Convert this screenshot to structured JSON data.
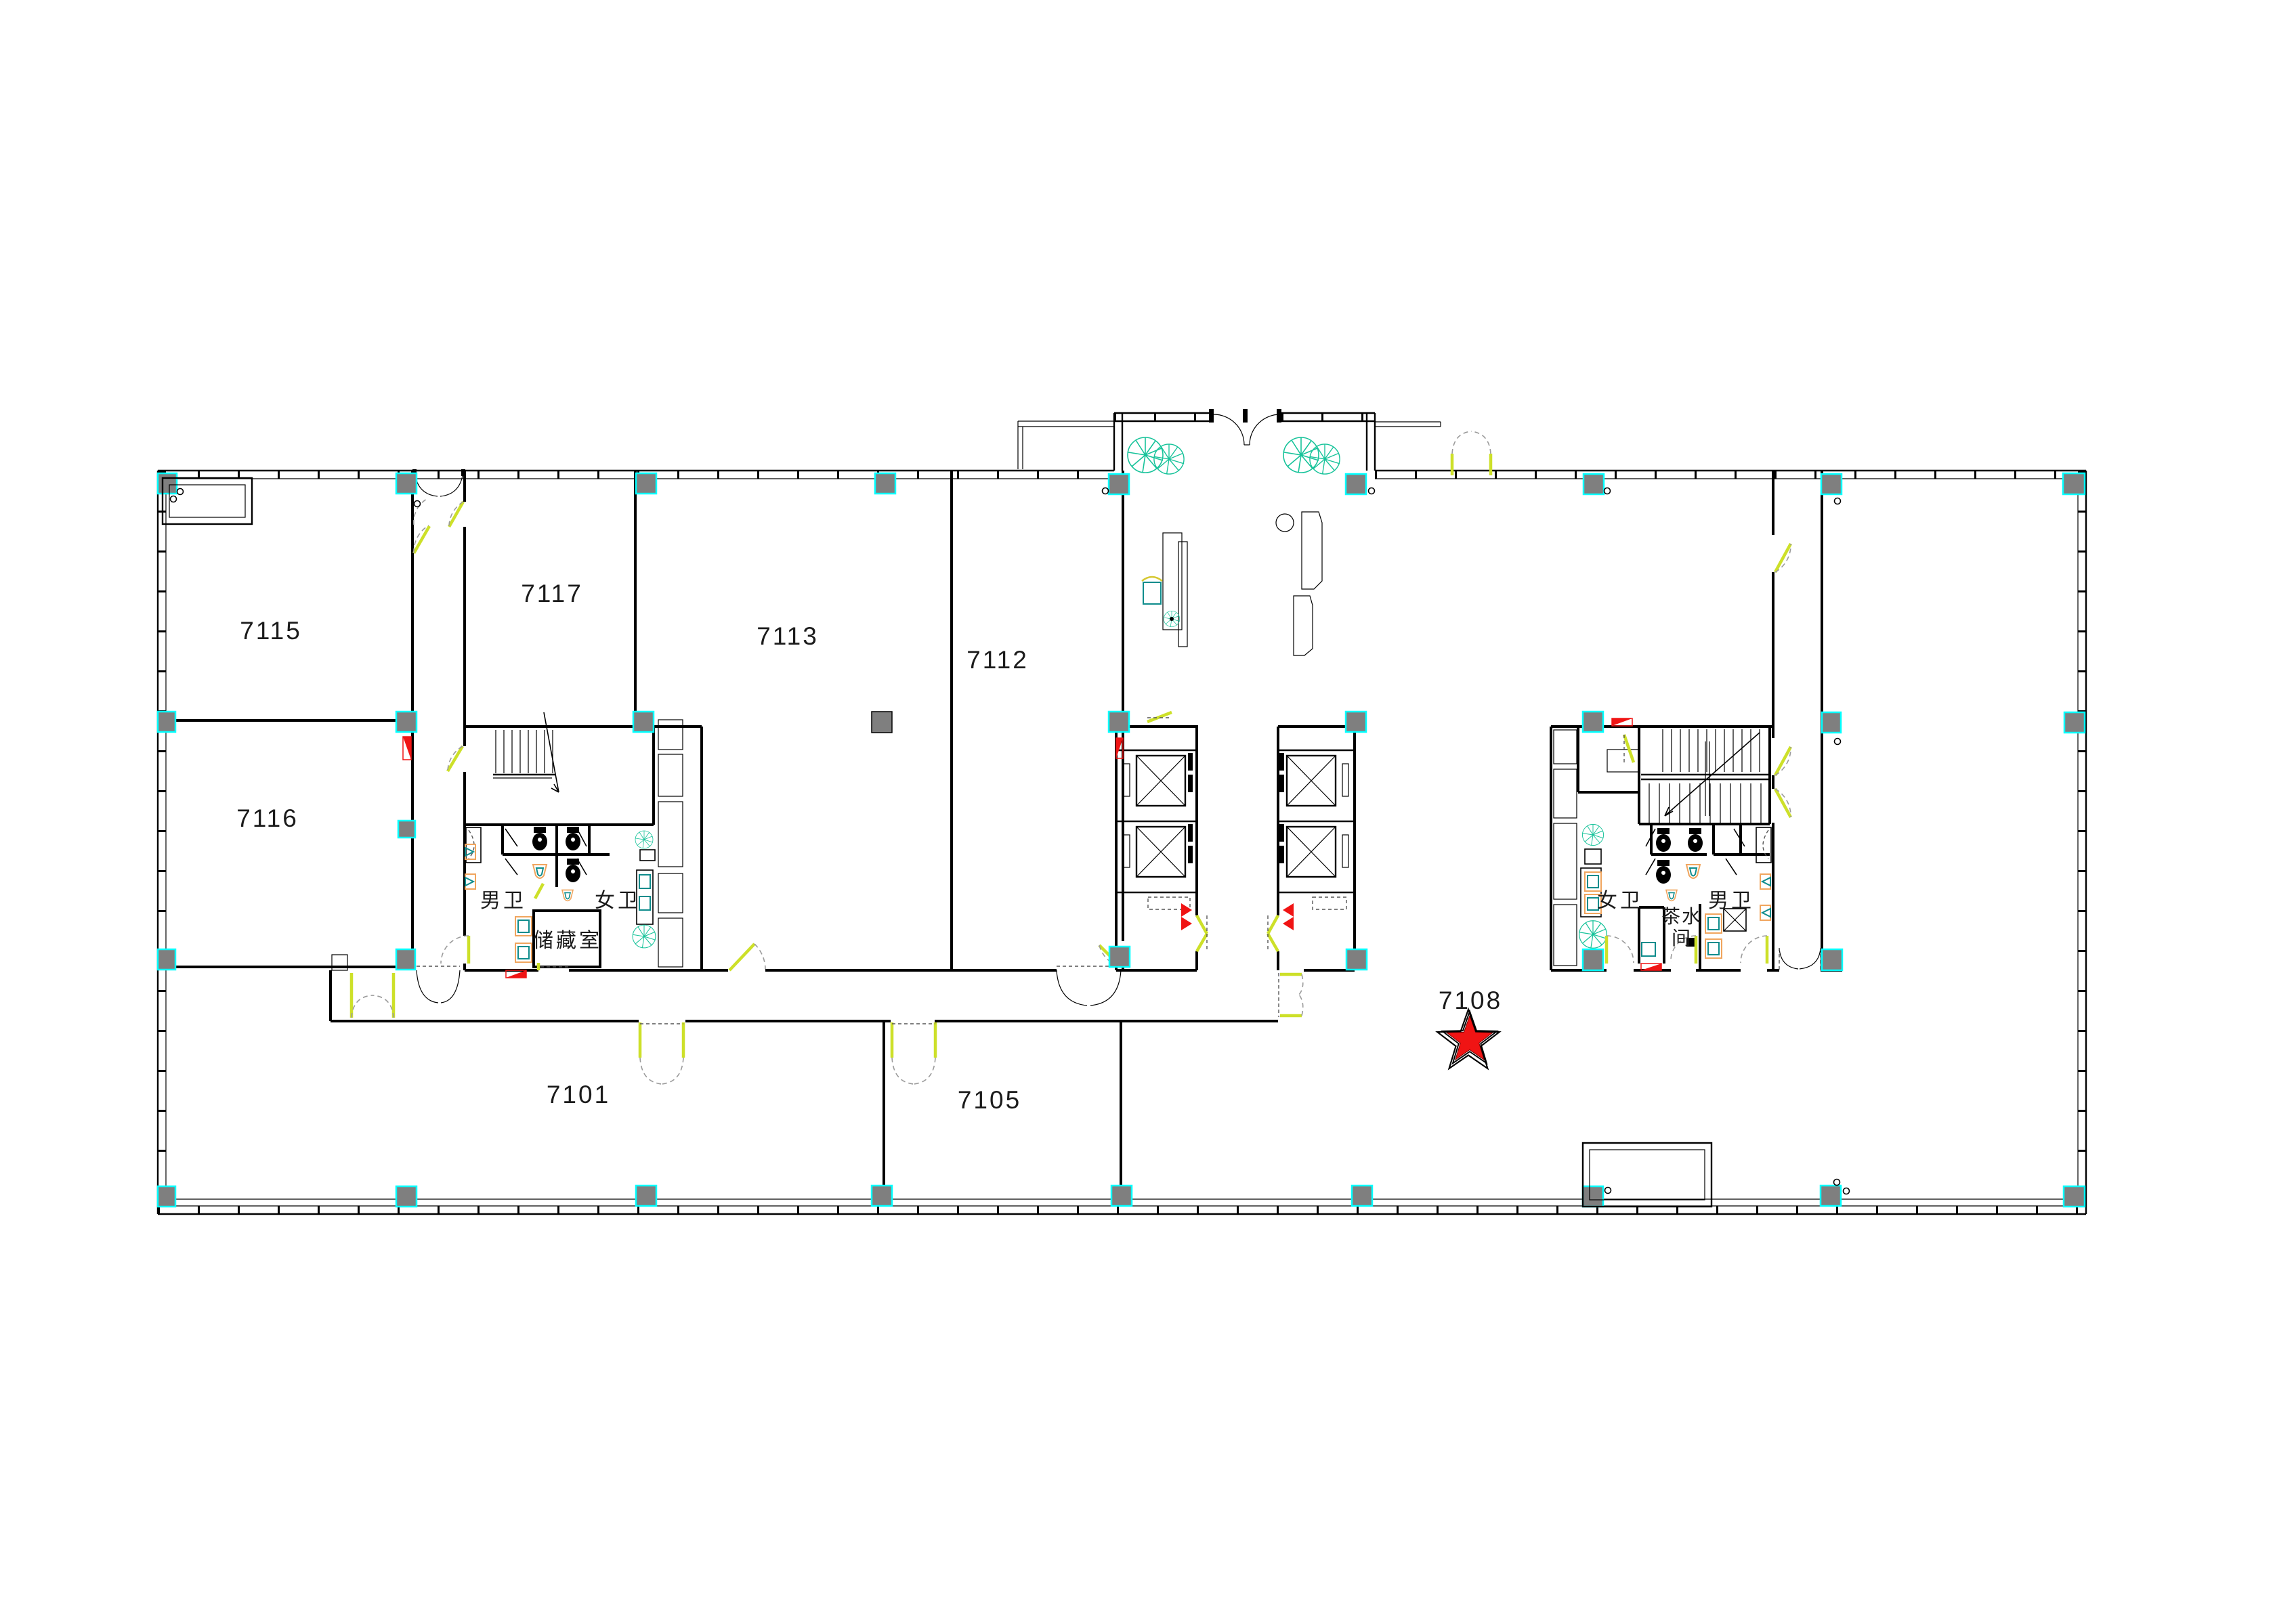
{
  "floor_plan": {
    "type": "architectural-floor-plan",
    "room_labels": {
      "r7101": "7101",
      "r7105": "7105",
      "r7108": "7108",
      "r7112": "7112",
      "r7113": "7113",
      "r7115": "7115",
      "r7116": "7116",
      "r7117": "7117"
    },
    "facility_labels": {
      "male_wc_west": "男卫",
      "female_wc_west": "女卫",
      "storage_room": "储藏室",
      "female_wc_east": "女卫",
      "male_wc_east": "男卫",
      "tea_room_line1": "茶水",
      "tea_room_line2": "间"
    },
    "highlight": {
      "room": "7108",
      "marker": "red-star"
    },
    "colors": {
      "wall": "#000000",
      "column_fill": "#7f7f7f",
      "column_outline": "#00ffff",
      "door_leaf": "#cde029",
      "swing_arc": "#9b9b9b",
      "plant": "#17c39a",
      "fixture_teal": "#0e8c8c",
      "fixture_orange": "#f0a55e",
      "marker_red": "#f01414"
    }
  }
}
